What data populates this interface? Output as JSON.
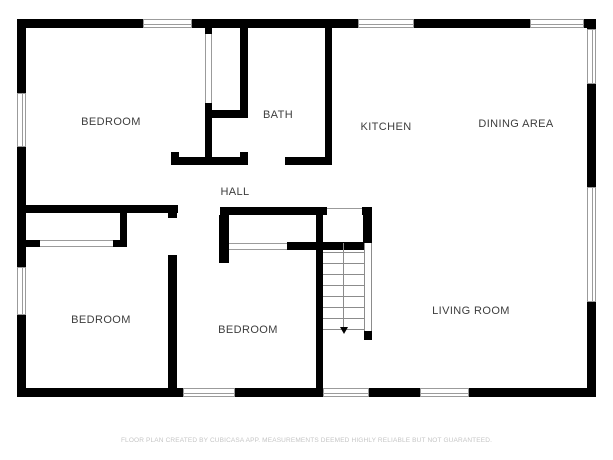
{
  "rooms": [
    {
      "id": "bedroom-top-left",
      "label": "BEDROOM"
    },
    {
      "id": "bath",
      "label": "BATH"
    },
    {
      "id": "kitchen",
      "label": "KITCHEN"
    },
    {
      "id": "dining-area",
      "label": "DINING AREA"
    },
    {
      "id": "hall",
      "label": "HALL"
    },
    {
      "id": "bedroom-bottom-left",
      "label": "BEDROOM"
    },
    {
      "id": "bedroom-bottom-middle",
      "label": "BEDROOM"
    },
    {
      "id": "living-room",
      "label": "LIVING ROOM"
    }
  ],
  "stairs": {
    "type": "straight-run",
    "treads": 8,
    "direction": "down"
  },
  "footer": "FLOOR PLAN CREATED BY CUBICASA APP. MEASUREMENTS DEEMED HIGHLY RELIABLE BUT NOT GUARANTEED.",
  "colors": {
    "background": "#ffffff",
    "wall": "#000000",
    "window_line": "#9b9b9b",
    "stair_line": "#8c8c8c",
    "label_text": "#3d3d3d",
    "footer_text": "#c6c6c6"
  }
}
